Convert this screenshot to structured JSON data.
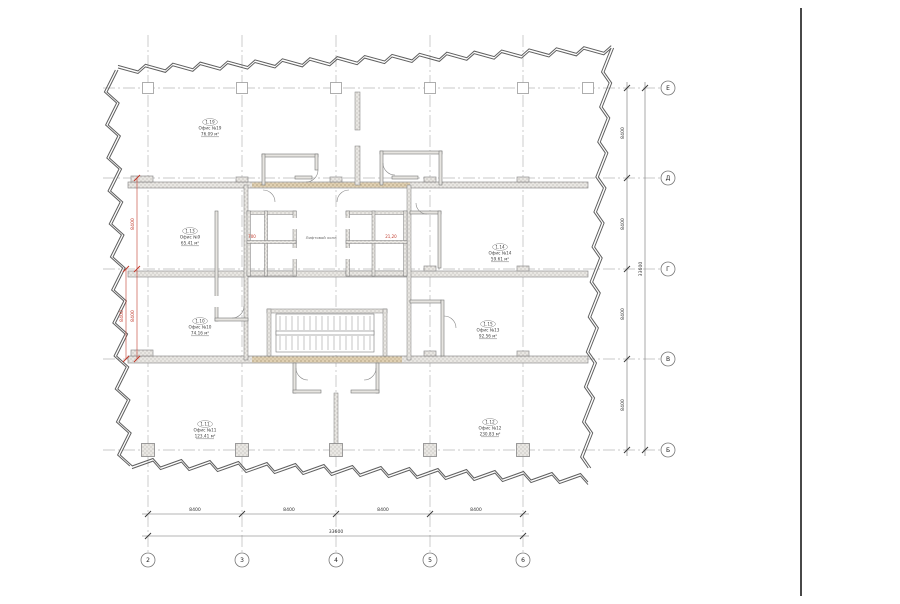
{
  "grid": {
    "rows": [
      "Е",
      "Д",
      "Г",
      "В",
      "Б"
    ],
    "cols": [
      "2",
      "3",
      "4",
      "5",
      "6"
    ]
  },
  "dimensions": {
    "bottom": {
      "segments": [
        "8400",
        "8400",
        "8400",
        "8400"
      ],
      "total": "33600"
    },
    "right": {
      "segments": [
        "8400",
        "8400",
        "8400",
        "8400"
      ],
      "total": "33600"
    },
    "left_red": {
      "segments": [
        "8400",
        "8400"
      ],
      "extra": "8400"
    }
  },
  "rooms": [
    {
      "num": "1.19",
      "name": "Офис №19",
      "area": "76.09 м²"
    },
    {
      "num": "1.13",
      "name": "Офис №9",
      "area": "65.41 м²"
    },
    {
      "num": "1.10",
      "name": "Офис №10",
      "area": "74.16 м²"
    },
    {
      "num": "1.11",
      "name": "Офис №11",
      "area": "123.41 м²"
    },
    {
      "num": "1.12",
      "name": "Офис №12",
      "area": "230.83 м²"
    },
    {
      "num": "1.15",
      "name": "Офис №13",
      "area": "92.56 м²"
    },
    {
      "num": "1.14",
      "name": "Офис №14",
      "area": "59.61 м²"
    }
  ],
  "core": {
    "lobby_label": "Лифтовой холл",
    "red_marks": [
      "700",
      "21,20"
    ]
  },
  "colors": {
    "dimension_red": "#c0392b",
    "slab_tan": "#d9c3a2",
    "hatch_gray": "#8f8f8f"
  }
}
